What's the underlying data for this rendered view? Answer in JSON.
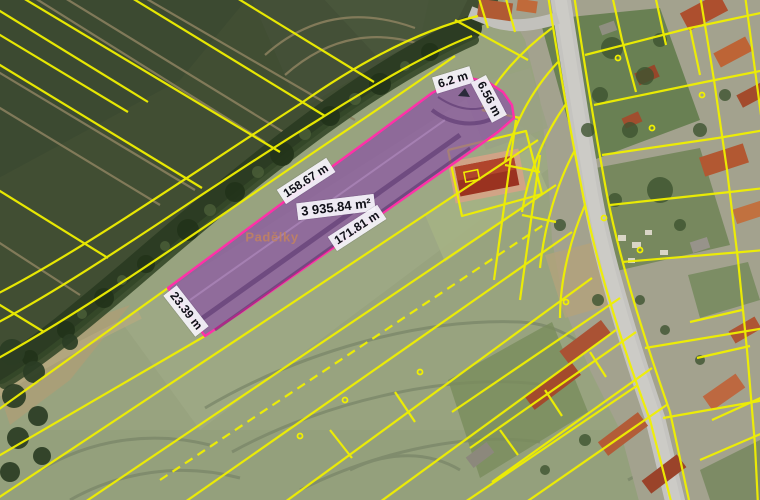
{
  "map": {
    "place_name": "Padělky",
    "parcel": {
      "area": "3 935.84 m²",
      "edge_top_a": "6.2 m",
      "edge_top_b": "6.56 m",
      "length_upper": "158.67 m",
      "length_lower": "171.81 m",
      "edge_left": "23.39 m"
    },
    "colors": {
      "cadastral_line": "#f0f000",
      "parcel_fill": "#8b55a4",
      "parcel_stroke": "#ff30a8",
      "label_bg": "#f4f2fa",
      "label_text": "#111111",
      "place_label": "#c08262"
    }
  }
}
